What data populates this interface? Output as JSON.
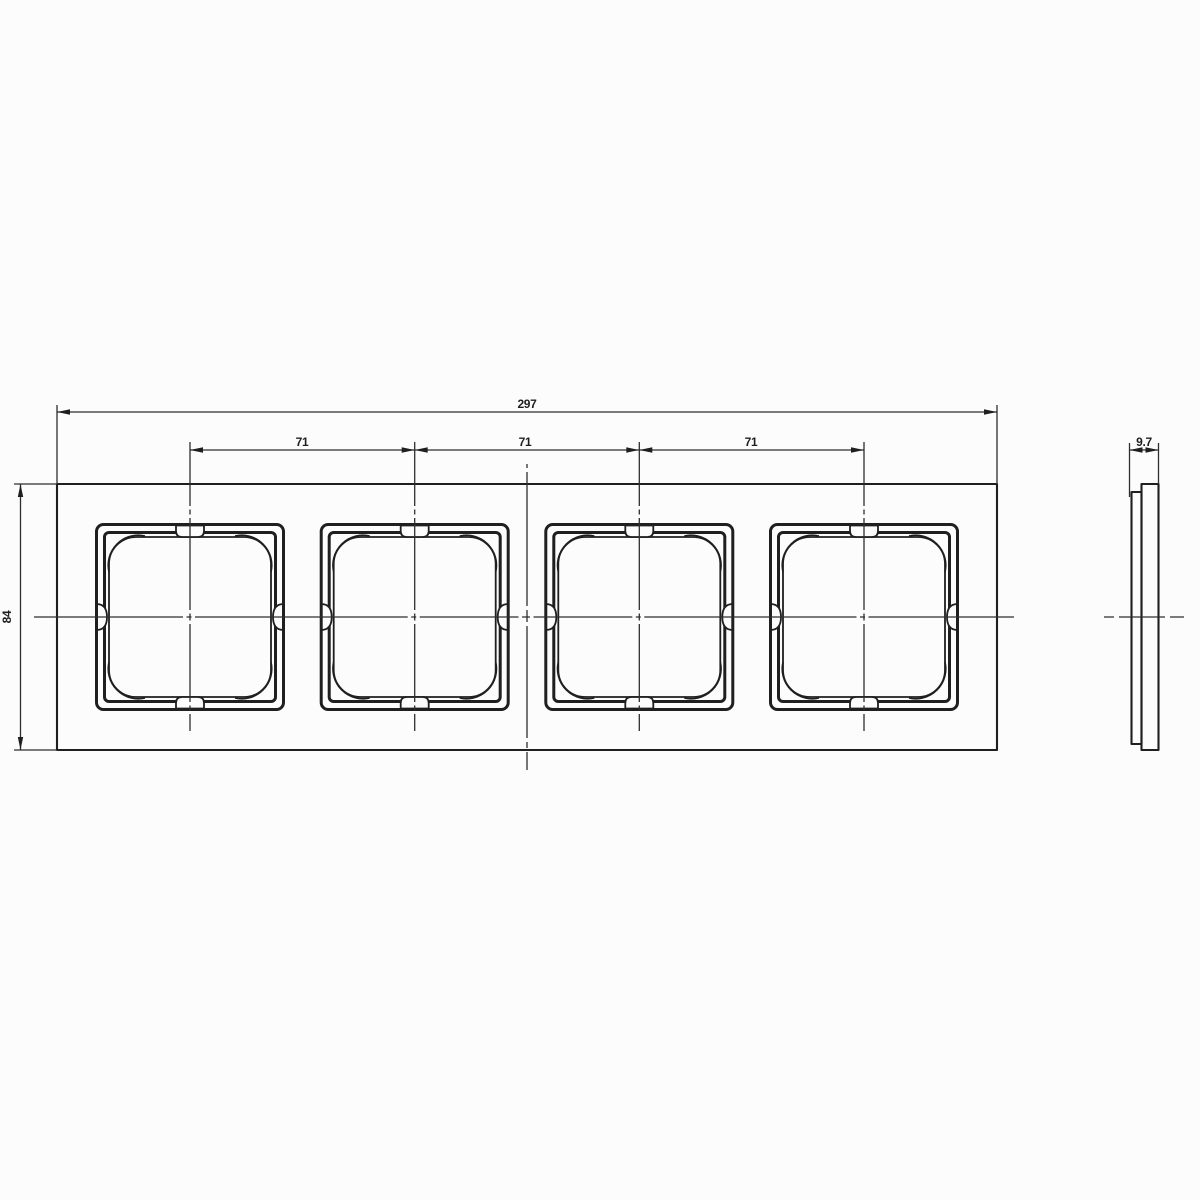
{
  "dims": {
    "overall_width": "297",
    "pitch": [
      "71",
      "71",
      "71"
    ],
    "height": "84",
    "thickness": "9.7"
  },
  "colors": {
    "line": "#1f1f1f",
    "line_thin": "#2e2e2e",
    "background": "#fcfcfc"
  }
}
